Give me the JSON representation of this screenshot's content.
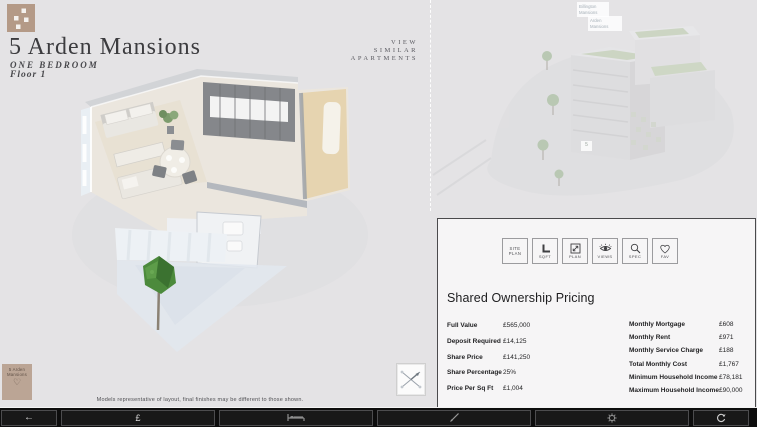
{
  "colors": {
    "accent_tan": "#b49a87",
    "page_bg": "#e4e3e5",
    "panel_bg": "#f6f5f6",
    "panel_border": "#4a4a4c",
    "toolbar_bg": "#0d0d0d",
    "text_dark": "#1f1f21"
  },
  "header": {
    "title": "5 Arden Mansions",
    "unit_type": "ONE BEDROOM",
    "floor": "Floor 1"
  },
  "view_similar": {
    "line1": "VIEW",
    "line2": "SIMILAR",
    "line3": "APARTMENTS"
  },
  "floorplan": {
    "disclaimer": "Models representative of layout, final finishes may be different to those shown."
  },
  "thumbnail": {
    "label": "5 Arden Mansions",
    "heart": "♡"
  },
  "site_overview": {
    "building_label_1": "Billington Mansions",
    "building_label_2": "Arden Mansions",
    "unit_tag": "5"
  },
  "panel": {
    "heading": "Shared Ownership Pricing",
    "icon_buttons": [
      {
        "label": "SITE PLAN"
      },
      {
        "label": "SQFT"
      },
      {
        "label": "PLAN"
      },
      {
        "label": "VIEWS"
      },
      {
        "label": "SPEC"
      },
      {
        "label": "FAV"
      }
    ],
    "pricing_left": [
      {
        "label": "Full Value",
        "value": "£565,000"
      },
      {
        "label": "Deposit Required",
        "value": "£14,125"
      },
      {
        "label": "Share Price",
        "value": "£141,250"
      },
      {
        "label": "Share Percentage",
        "value": "25%"
      },
      {
        "label": "Price Per Sq Ft",
        "value": "£1,004"
      }
    ],
    "pricing_right": [
      {
        "label": "Monthly Mortgage",
        "value": "£608"
      },
      {
        "label": "Monthly Rent",
        "value": "£971"
      },
      {
        "label": "Monthly Service Charge",
        "value": "£188"
      },
      {
        "label": "Total Monthly Cost",
        "value": "£1,767"
      },
      {
        "label": "Minimum Household Income",
        "value": "£78,181"
      },
      {
        "label": "Maximum Household Income",
        "value": "£90,000"
      }
    ]
  },
  "toolbar": {
    "back_glyph": "←",
    "pound_glyph": "£"
  }
}
